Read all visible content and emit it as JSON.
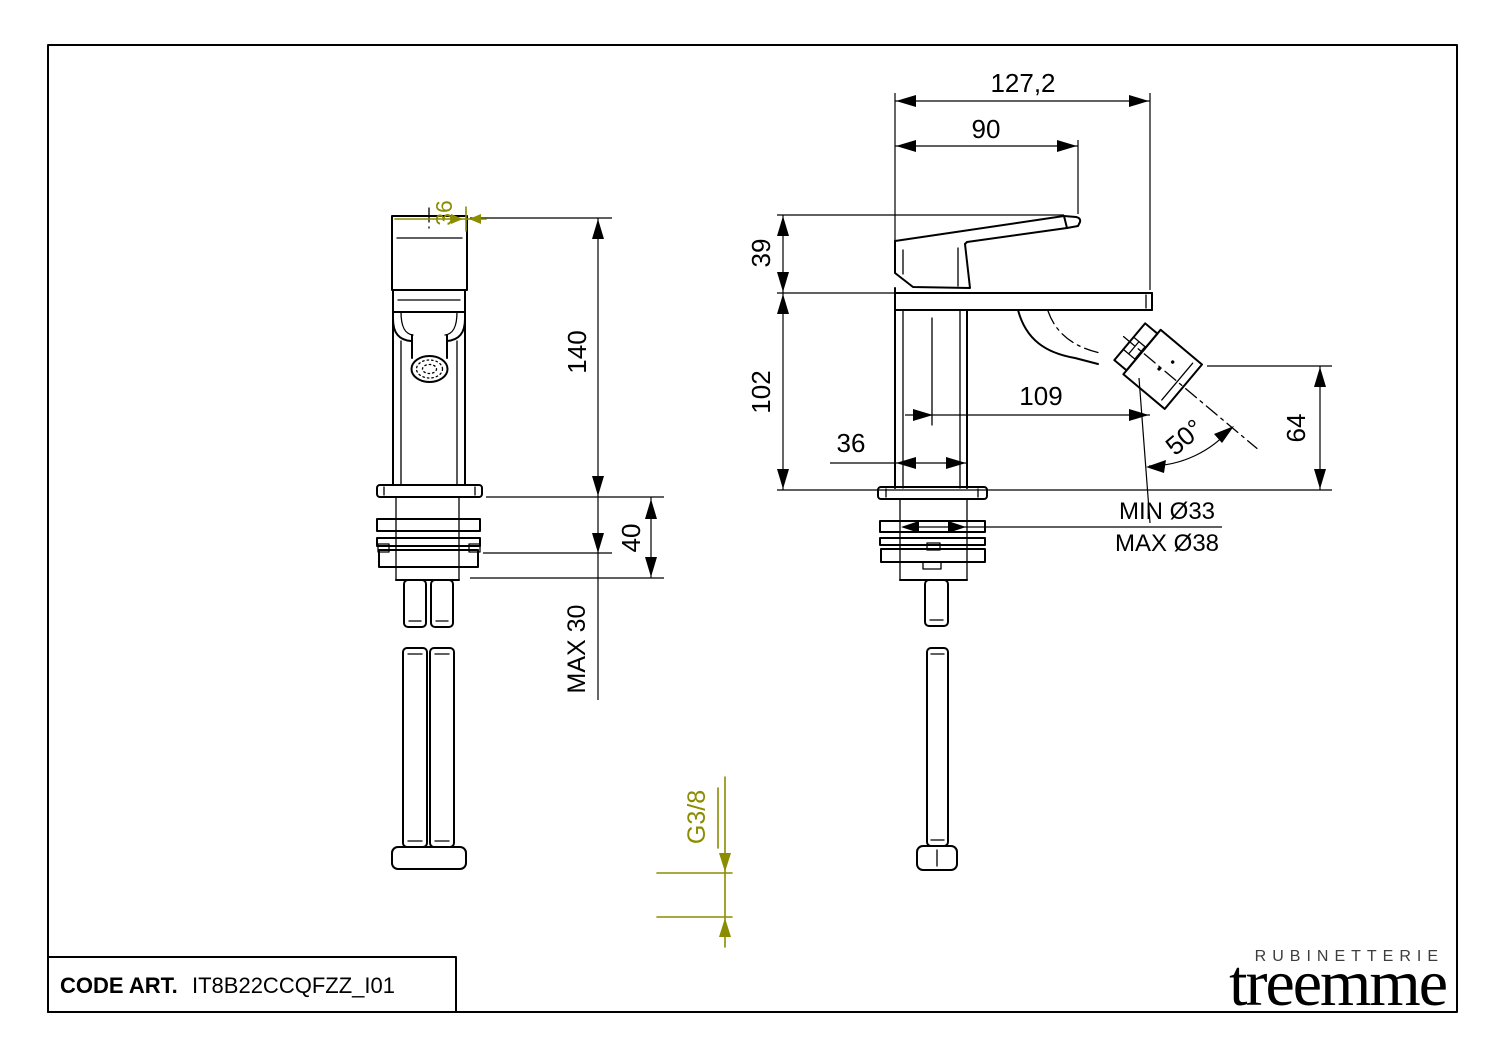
{
  "drawing": {
    "front_view": {
      "dim_top_width": "36",
      "dim_total_height": "140",
      "dim_mount_stack": "40",
      "dim_max_panel": "MAX 30"
    },
    "side_view": {
      "dim_overall_depth": "127,2",
      "dim_handle_reach": "90",
      "dim_handle_height": "39",
      "dim_body_height": "102",
      "dim_spout_reach": "109",
      "dim_body_depth": "36",
      "dim_spray_angle": "50°",
      "dim_spray_height": "64",
      "dim_hole_min": "MIN Ø33",
      "dim_hole_max": "MAX Ø38"
    },
    "connection": {
      "thread_label": "G3/8"
    }
  },
  "title_block": {
    "label": "CODE ART.",
    "code": "IT8B22CCQFZZ_I01"
  },
  "logo": {
    "top": "RUBINETTERIE",
    "name": "treemme"
  },
  "colors": {
    "line": "#000000",
    "annotation": "#8c8c00",
    "background": "#ffffff"
  }
}
